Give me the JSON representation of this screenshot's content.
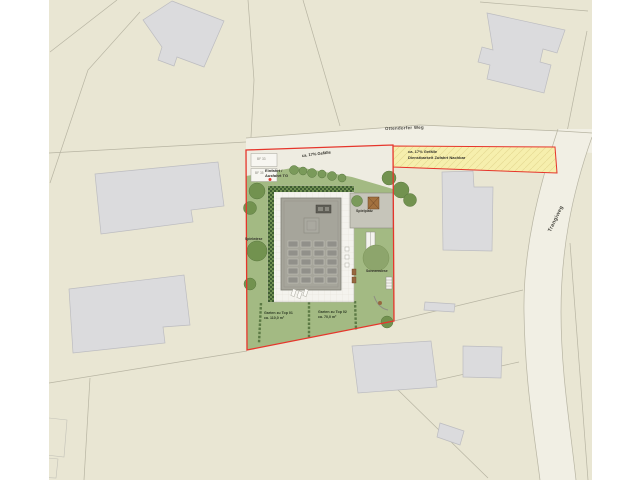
{
  "labels": {
    "street_top": "Ottendorfer Weg",
    "street_right": "Trangiweg",
    "driveway_slope": "ca. 17% Gefälle",
    "easement_line1": "ca. 17% Gefälle",
    "easement_line2": "Dienstbarkeit Zufahrt Nachbar",
    "garage_entry_line1": "Einfahrt /",
    "garage_entry_line2": "Ausfahrt TG",
    "parking_space_1": "BF 33",
    "parking_space_2": "BF 35",
    "playground": "Spielplatz",
    "sun_meadow": "Sonnenwiese",
    "play_meadow": "Spielwiese",
    "garden1_line1": "Garten zu Top 01",
    "garden1_line2": "ca. 110,0 m²",
    "garden2_line1": "Garten zu Top 02",
    "garden2_line2": "ca. 70,0 m²"
  },
  "colors": {
    "site_boundary_red": "#e6352b",
    "easement_yellow": "#f6efad",
    "garden_green": "#a3ba83",
    "map_beige": "#e9e6d3",
    "building_gray": "#dbdbdd",
    "roof_gray": "#a6a59b",
    "road_light": "#f1efe4"
  }
}
